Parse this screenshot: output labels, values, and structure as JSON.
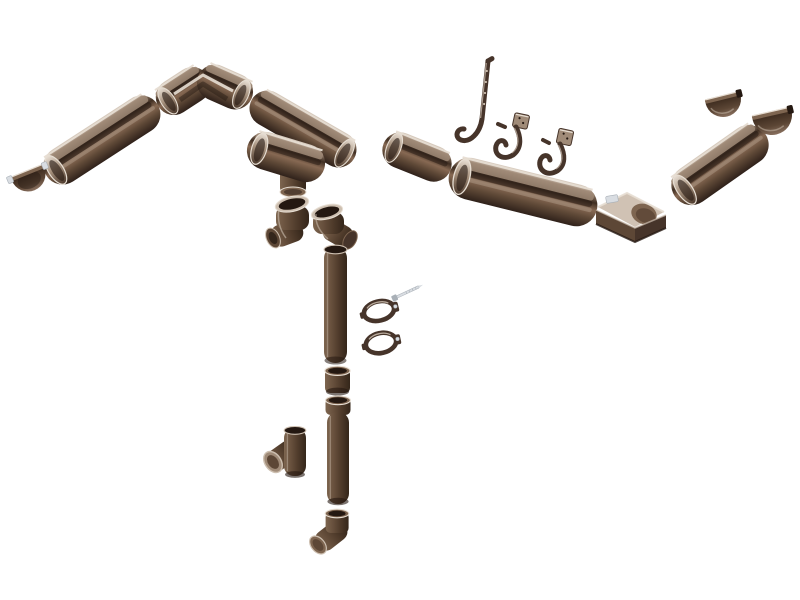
{
  "alt": "Exploded assembly view of a chocolate-brown half-round rain gutter and downpipe system on a white background",
  "palette": {
    "background": "#ffffff",
    "rim_light": "#e7ded3",
    "tan_light": "#cdbfb0",
    "tan_interior": "#a08b78",
    "brown_light": "#7e6550",
    "brown_mid": "#5d4736",
    "brown_dark": "#46342a",
    "brown_darkest": "#241811",
    "gutter_rim": "#ded3c7",
    "gutter_inner": "#9d8673",
    "gutter_shadow": "#3f2e22",
    "gutter_front_hi": "#876953",
    "gutter_front": "#5f4937",
    "gutter_deep": "#2f211a",
    "pipe_hi": "#7d654f",
    "pipe_mid": "#654e3b",
    "pipe_low": "#4e3a2a",
    "pipe_deep": "#34261a",
    "open_hi": "#e9e0d6",
    "open_mid": "#a8937f",
    "open_low": "#4b382b",
    "cap_top": "#3f2d20",
    "cap_mid": "#5c4635",
    "cap_low": "#8a7160",
    "metal_light": "#d9dde2",
    "metal_mid": "#a9b0b7"
  },
  "components": [
    {
      "id": "end-cap-left",
      "label": "Gutter end cap (left)"
    },
    {
      "id": "gutter-left",
      "label": "Gutter section, left run"
    },
    {
      "id": "inside-corner",
      "label": "Gutter inside corner 90 degrees"
    },
    {
      "id": "gutter-a",
      "label": "Gutter section A"
    },
    {
      "id": "funnel",
      "label": "Gutter outlet funnel"
    },
    {
      "id": "elbow-a",
      "label": "Downpipe elbow A"
    },
    {
      "id": "elbow-b",
      "label": "Downpipe elbow B"
    },
    {
      "id": "gutter-b",
      "label": "Gutter section B"
    },
    {
      "id": "hook-long",
      "label": "Long strap gutter hook"
    },
    {
      "id": "hook-medium",
      "label": "Fascia gutter hook"
    },
    {
      "id": "hook-small",
      "label": "Fascia gutter hook, small"
    },
    {
      "id": "gutter-c",
      "label": "Gutter section C"
    },
    {
      "id": "outside-corner",
      "label": "Gutter outside corner 90 degrees"
    },
    {
      "id": "gutter-d",
      "label": "Gutter section D"
    },
    {
      "id": "end-cap-right-upper",
      "label": "Gutter end cap, right upper"
    },
    {
      "id": "end-cap-right-lower",
      "label": "Gutter end cap, right lower"
    },
    {
      "id": "downpipe-upper",
      "label": "Downpipe, upper length"
    },
    {
      "id": "coupler",
      "label": "Downpipe coupler"
    },
    {
      "id": "downpipe-lower",
      "label": "Downpipe, lower length"
    },
    {
      "id": "shoe",
      "label": "Downpipe shoe outlet"
    },
    {
      "id": "tee",
      "label": "Downpipe tee branch"
    },
    {
      "id": "clamp-a",
      "label": "Pipe clamp A"
    },
    {
      "id": "clamp-b",
      "label": "Pipe clamp B"
    },
    {
      "id": "screw",
      "label": "Mounting screw"
    }
  ]
}
